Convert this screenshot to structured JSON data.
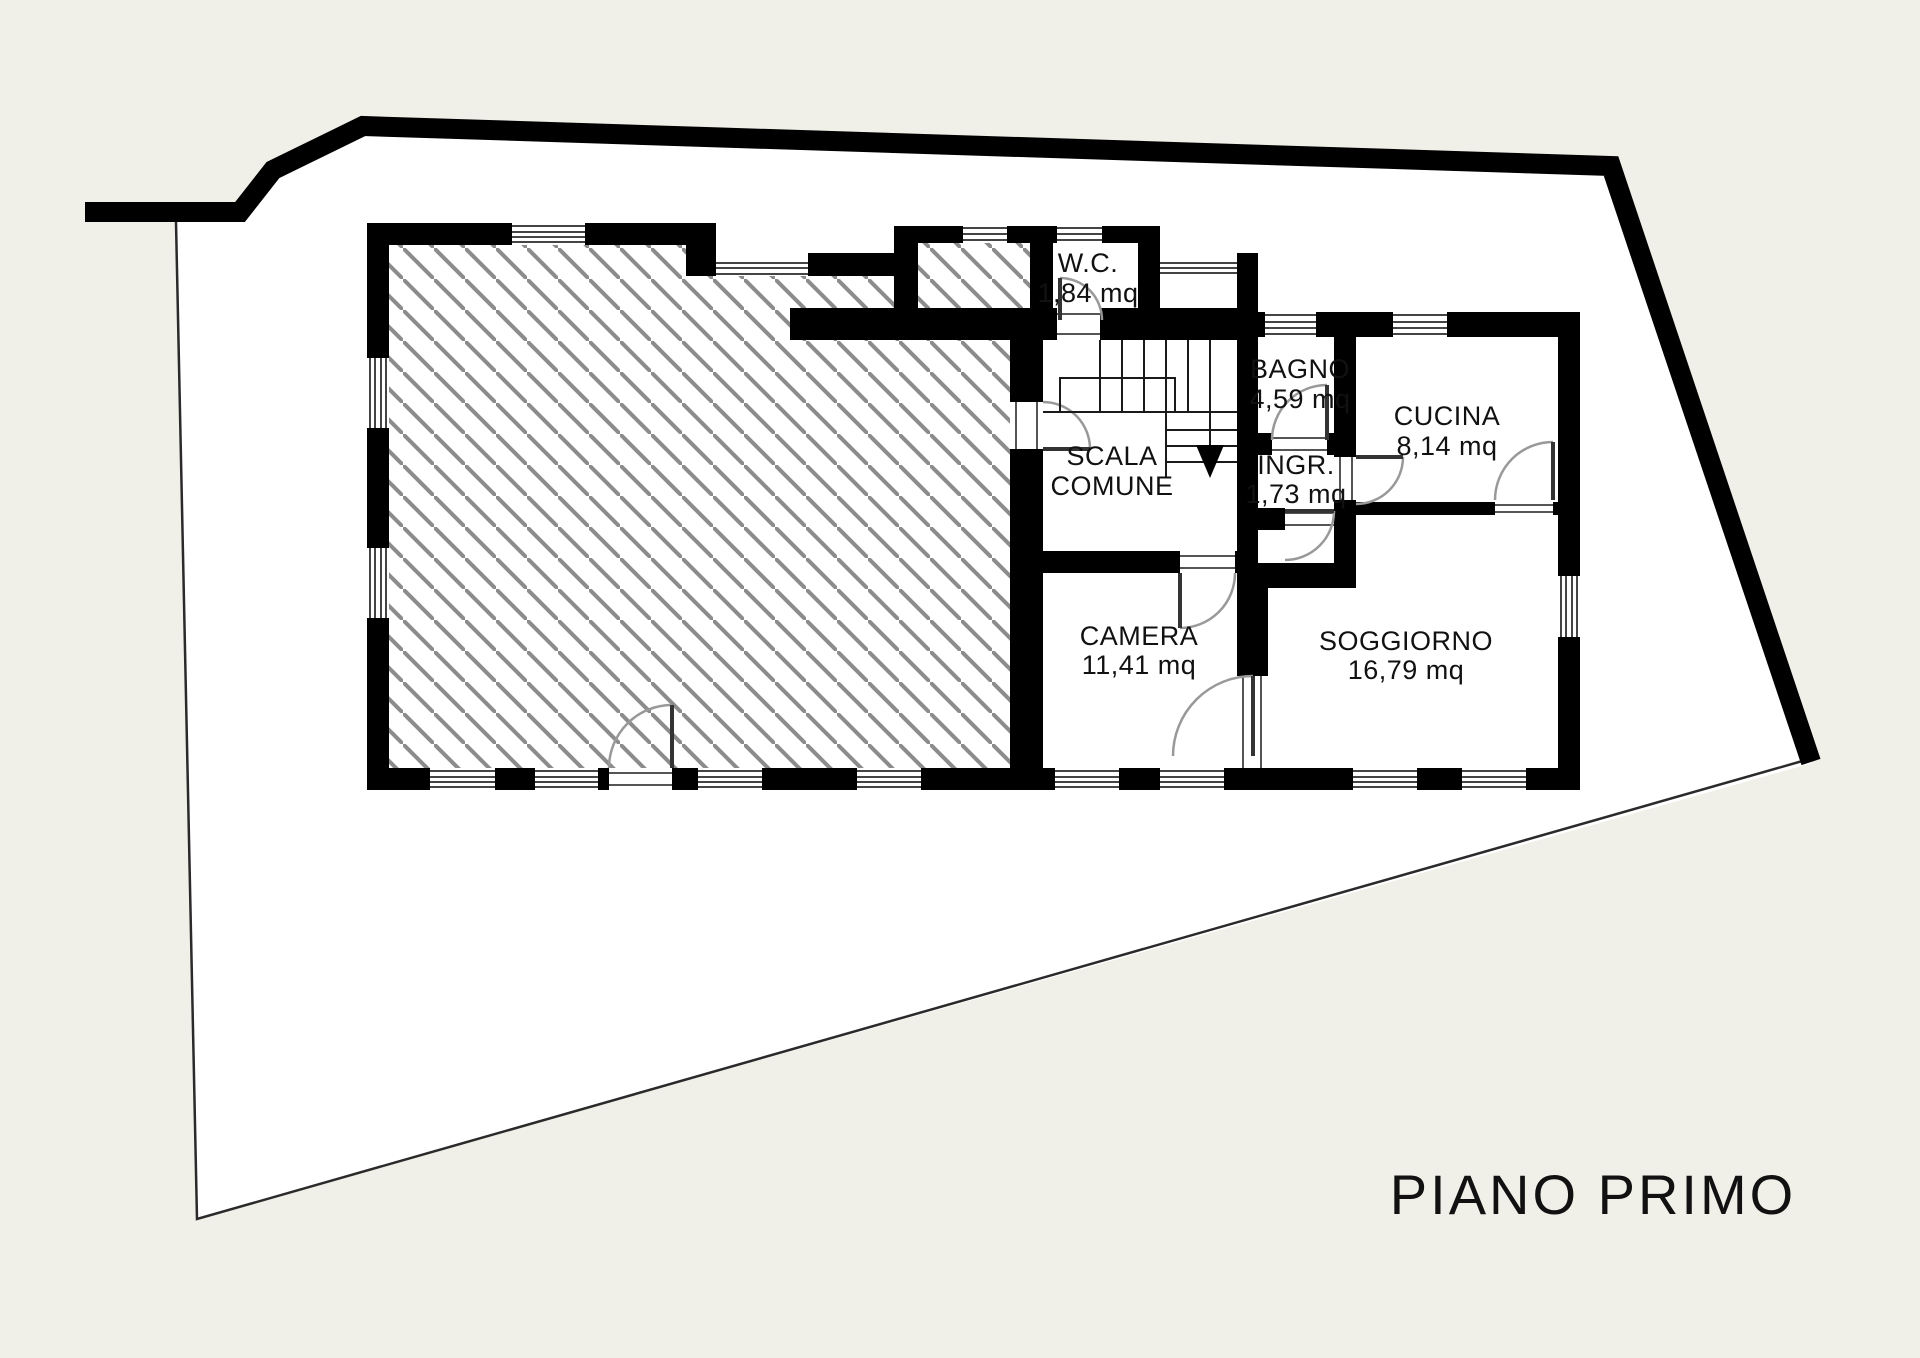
{
  "title": "PIANO PRIMO",
  "rooms": [
    {
      "id": "wc",
      "name": "W.C.",
      "area": "1,84 mq"
    },
    {
      "id": "bagno",
      "name": "BAGNO",
      "area": "4,59 mq"
    },
    {
      "id": "cucina",
      "name": "CUCINA",
      "area": "8,14 mq"
    },
    {
      "id": "scala",
      "name": "SCALA",
      "name2": "COMUNE",
      "area": ""
    },
    {
      "id": "ingresso",
      "name": "INGR.",
      "area": "1,73 mq"
    },
    {
      "id": "camera",
      "name": "CAMERA",
      "area": "11,41 mq"
    },
    {
      "id": "soggiorno",
      "name": "SOGGIORNO",
      "area": "16,79 mq"
    }
  ],
  "symbols": {
    "stairs_direction": "down-arrow",
    "hatch": "diagonal-lines"
  },
  "colors": {
    "background": "#f0efe8",
    "paper": "#ffffff",
    "wall": "#000000",
    "hatch_line": "#8c8c8c",
    "thin_line": "#2a2a2a",
    "door_arc": "#999999"
  }
}
